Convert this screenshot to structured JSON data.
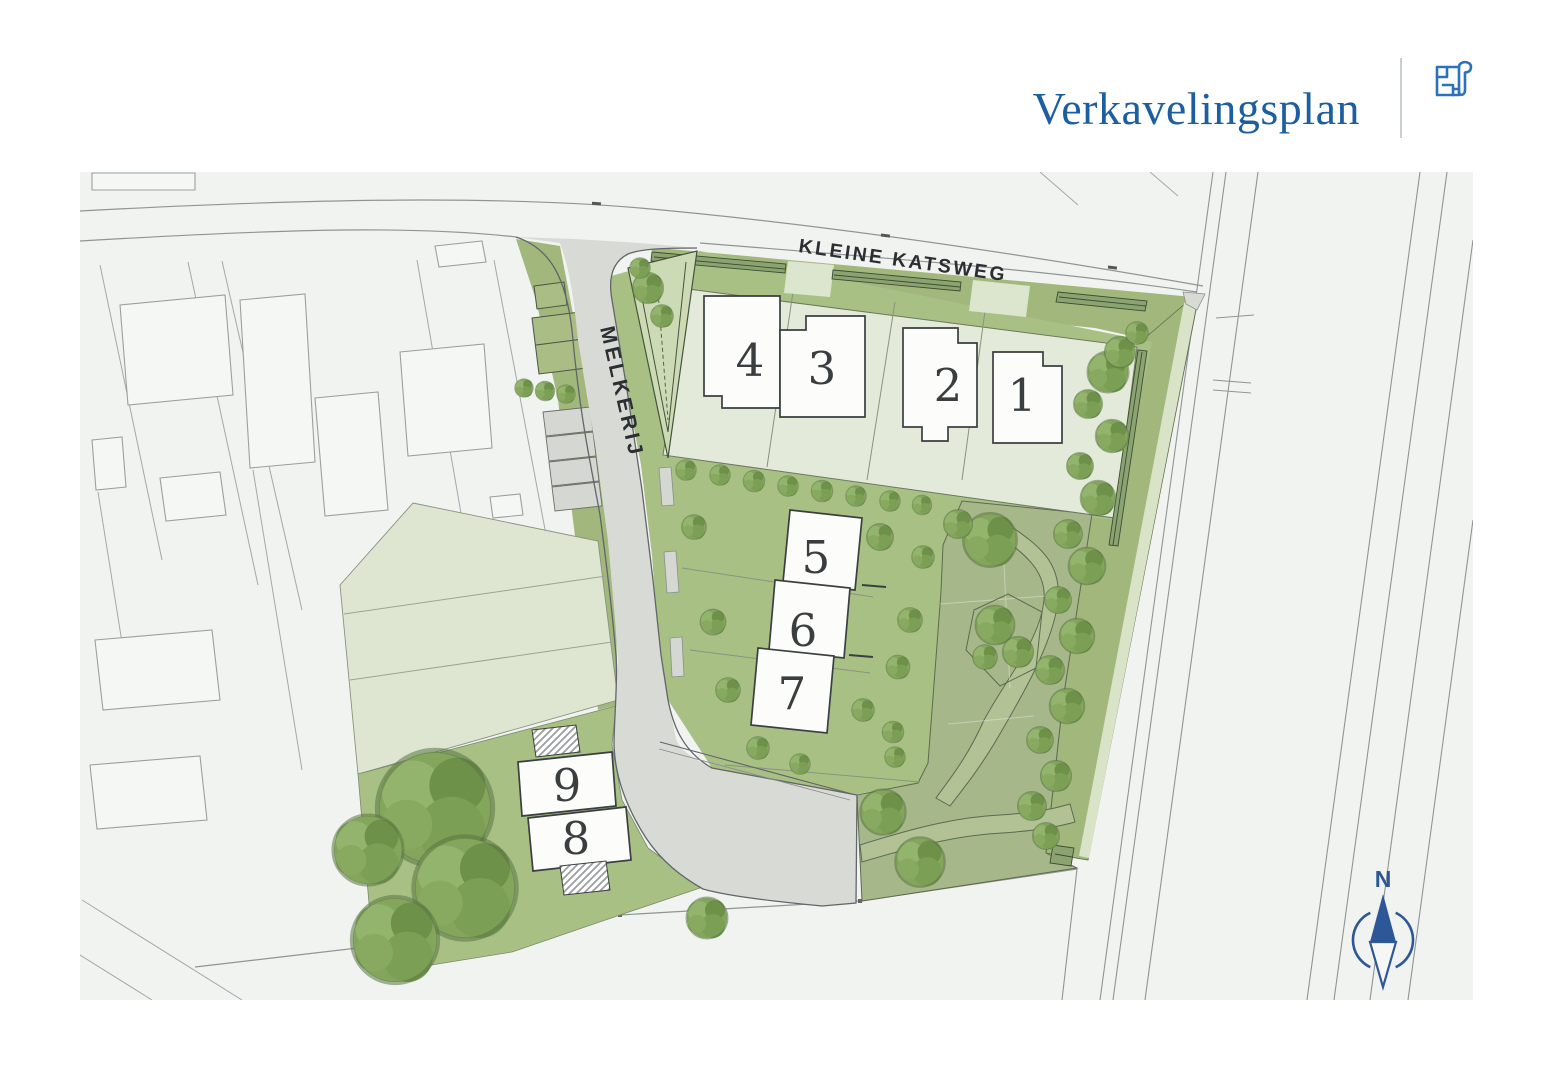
{
  "header": {
    "title": "Verkavelingsplan"
  },
  "plan": {
    "streets": {
      "kleine_katsweg": "KLEINE KATSWEG",
      "melkerij": "MELKERIJ"
    },
    "lot_numbers": [
      "1",
      "2",
      "3",
      "4",
      "5",
      "6",
      "7",
      "8",
      "9"
    ],
    "compass_north": "N"
  },
  "colors": {
    "title_blue": "#1b5fa1",
    "icon_blue": "#2b72ba",
    "compass_blue": "#2d5796",
    "map_background": "#f1f3f1",
    "plot_light_green": "#e3ead9",
    "parcel_pale_green": "#dee6d1",
    "garden_green": "#a9c084",
    "park_green": "#a6b78a",
    "verge_green": "#a2b77c",
    "street_gray": "#d8dad6",
    "hedge_dark": "#3d4d32",
    "building_white": "#fcfdfa",
    "outline_dark": "#3a3f41"
  }
}
